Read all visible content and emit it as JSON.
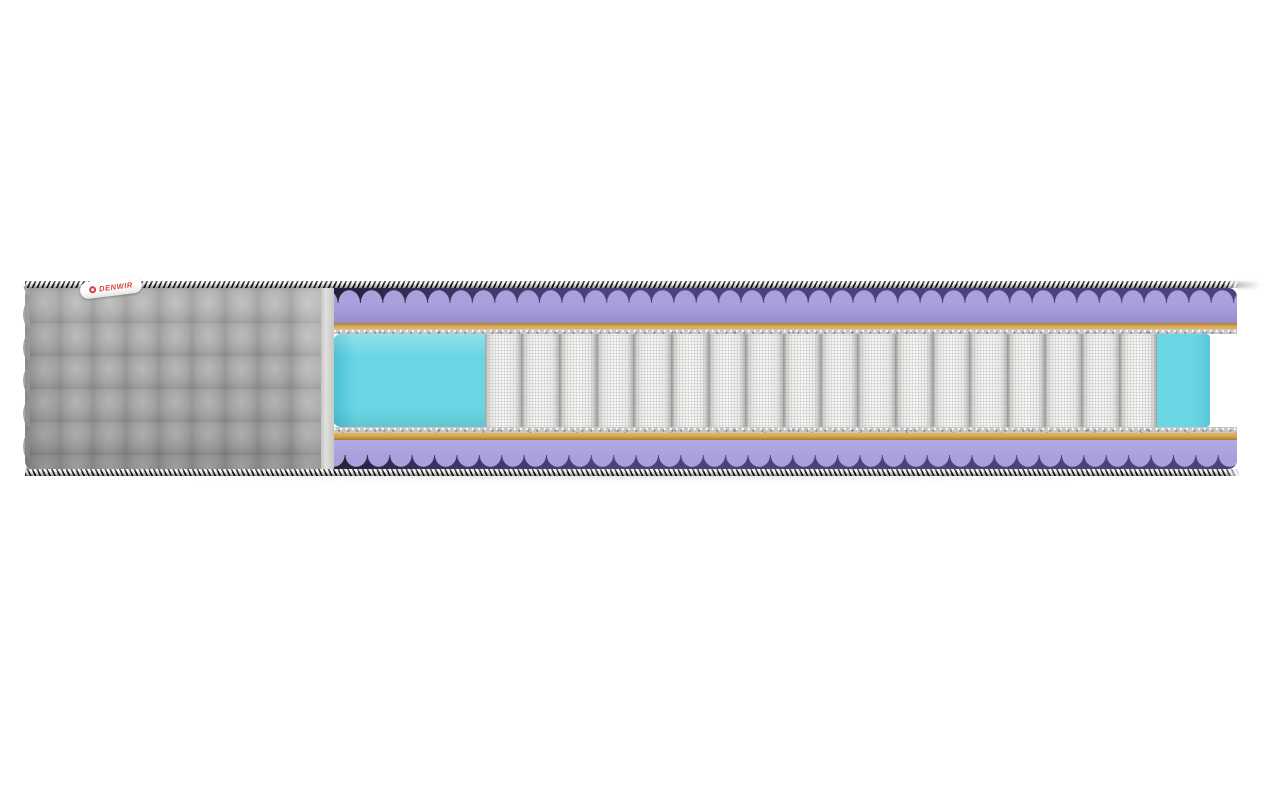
{
  "scene": {
    "type": "product-render",
    "subject": "mattress cross-section cutaway",
    "background_color": "#ffffff"
  },
  "brand_label": {
    "text": "DENWIR",
    "text_color": "#d6403c",
    "background": "#ffffff",
    "logo": "red-ring"
  },
  "mattress": {
    "cover": {
      "style": "gray quilted squares",
      "color": "#a7a7a5",
      "quilt_cell_px": 33
    },
    "edge_piping": {
      "style": "black-white diagonal striped cord",
      "colors": [
        "#1b1b1b",
        "#f6f6f6"
      ]
    },
    "layers_top_to_bottom": [
      {
        "name": "wavy comfort foam (egg-crate profile)",
        "color": "#a9a1dc",
        "shadow_color": "#4a4278"
      },
      {
        "name": "pad sheet",
        "color": "#d9a84e"
      },
      {
        "name": "felt pad",
        "color": "#c7c5c2"
      },
      {
        "name": "pocket spring core with side support foam",
        "spring_color": "#f5f5f3",
        "foam_color": "#69d6e3"
      },
      {
        "name": "felt pad",
        "color": "#c7c5c2"
      },
      {
        "name": "pad sheet",
        "color": "#d9a84e"
      },
      {
        "name": "wavy comfort foam (egg-crate profile)",
        "color": "#a9a1dc",
        "shadow_color": "#4a4278"
      }
    ],
    "springs": {
      "count": 18,
      "color": "#f5f5f3"
    }
  },
  "colors": {
    "bg": "#ffffff",
    "piping-black": "#1b1b1b",
    "piping-white": "#f6f6f6",
    "cover-gray": "#a7a7a5",
    "cover-light": "#bcbcba",
    "cover-dark": "#8a8a88",
    "cut-face": "#e0e0de",
    "purple-body": "#a9a1dc",
    "purple-dark": "#4a4278",
    "purple-deep": "#241f38",
    "orange": "#d9a84e",
    "orange-dark": "#a97c36",
    "felt": "#c7c5c2",
    "cyan": "#69d6e3",
    "cyan-dark": "#49bfd2",
    "spring-face": "#f5f5f3",
    "spring-edge": "#9f9f9d",
    "label-red": "#d6403c"
  }
}
